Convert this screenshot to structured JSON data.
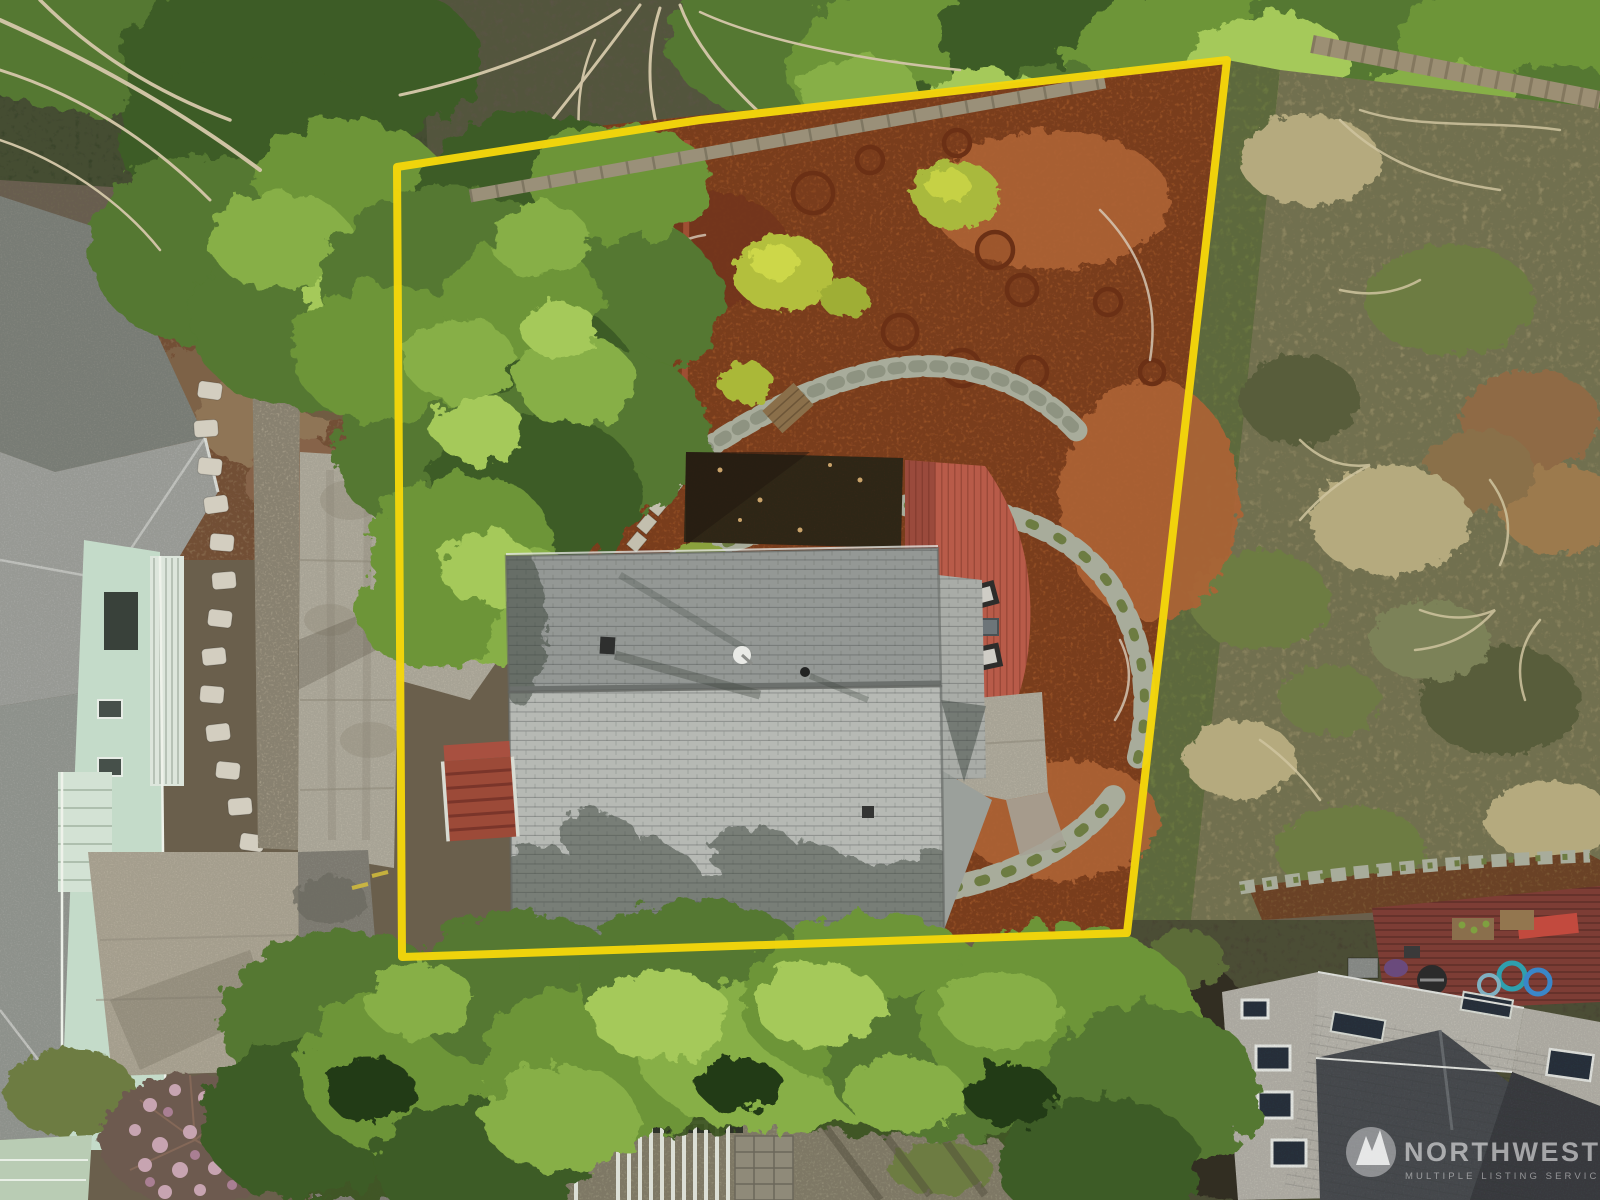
{
  "image": {
    "width": 1600,
    "height": 1200,
    "kind": "aerial-drone-photo",
    "subject": "overhead view of a residential lot with gray-shingle house, red back deck, terraced rock-and-mulch backyard, surrounded by evergreens and neighboring homes"
  },
  "boundary": {
    "color": "#F4D60B",
    "points": "397,167 700,120 1227,60 1127,933 402,957",
    "closed": true
  },
  "watermark": {
    "brand": "NORTHWEST",
    "tagline": "MULTIPLE LISTING SERVICE",
    "logo": "mountains-in-circle",
    "text_color": "#FFFFFF"
  },
  "palette": {
    "base": "#6a5f4c",
    "forestDark": "#37422a",
    "g1": "#3e5c25",
    "g2": "#547830",
    "g3": "#6d9539",
    "g4": "#87af47",
    "g5": "#a5c95a",
    "gsh": "#243a14",
    "mulch": "#99522a",
    "mulchDk": "#73341a",
    "mulchLt": "#ae6336",
    "scrub": "#8e8762",
    "scrubDk": "#585d3b",
    "scrubTan": "#b5aa7e",
    "moss": "#6d7c42",
    "roofA": "#949895",
    "roofB": "#b6b9b4",
    "roofEdge": "#6c706d",
    "flat": "#362a1f",
    "deck": "#b85b49",
    "deckDk": "#9a4a3c",
    "conc": "#b6b1a2",
    "concDk": "#97917f",
    "asph": "#86847a",
    "asphDk": "#6a685e",
    "stone": "#a8ac9b",
    "stoneDk": "#8e9381",
    "wood": "#9a9079",
    "branch": "#cfc3a4",
    "mint": "#c4dbc9",
    "white": "#e8ece5",
    "nroofA": "#83867f",
    "nroofB": "#a4a6a1",
    "char": "#4b4f53",
    "charDk": "#3c4044",
    "greige": "#b8b5ac",
    "maroon": "#7d3d35",
    "dirt": "#7c5a39",
    "blossom": "#c7a4b1",
    "blossom2": "#a97f93",
    "sky": "#2b3540",
    "teal": "#2f9fae",
    "blue": "#3a86c8",
    "redb": "#c24a3e",
    "benchwood": "#8a6f4a",
    "yellow": "#f4d60b"
  }
}
